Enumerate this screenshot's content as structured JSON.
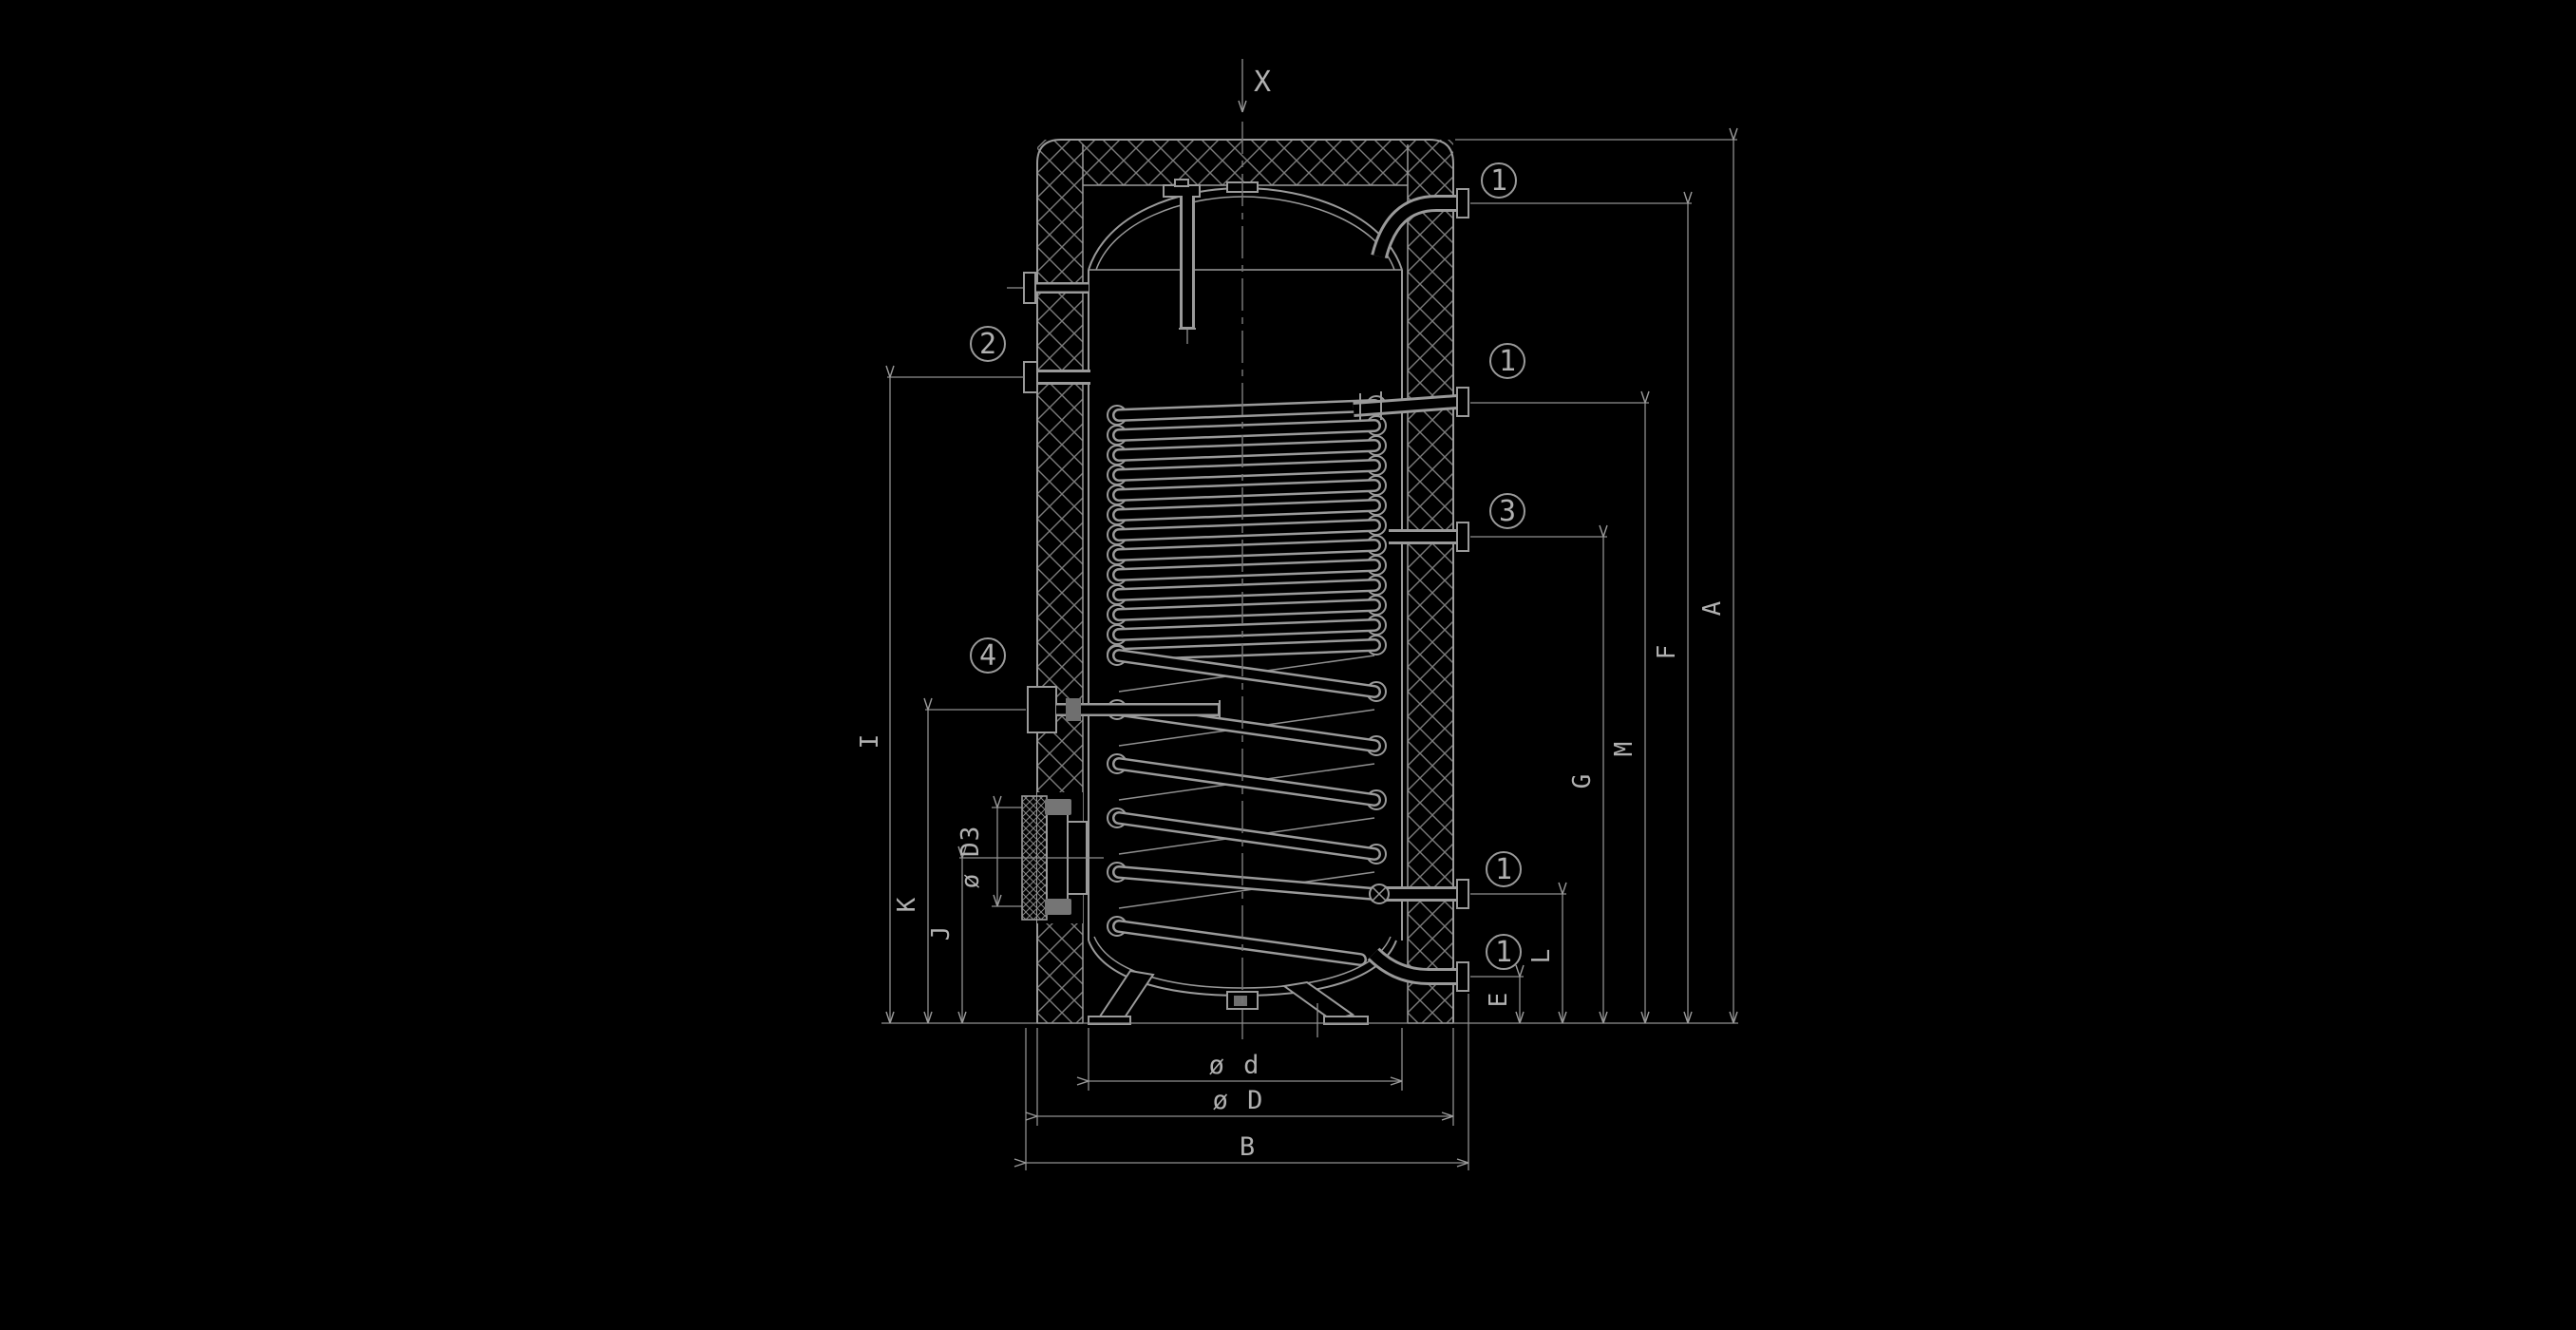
{
  "drawing": {
    "kind": "technical section drawing — insulated storage water heater with internal coil heat exchanger",
    "background": "#000000",
    "line_color": "#9a9a9a",
    "text_color": "#b0b0b0"
  },
  "top_marker": {
    "label": "X"
  },
  "callouts": {
    "n1": "1",
    "n2": "2",
    "n3": "3",
    "n4": "4"
  },
  "dimensions": {
    "A": "A",
    "F": "F",
    "M": "M",
    "G": "G",
    "L": "L",
    "E": "E",
    "I": "I",
    "K": "K",
    "J": "J",
    "flange": "ø D3",
    "inner_diameter": "ø d",
    "outer_diameter": "ø D",
    "overall_width": "B"
  }
}
